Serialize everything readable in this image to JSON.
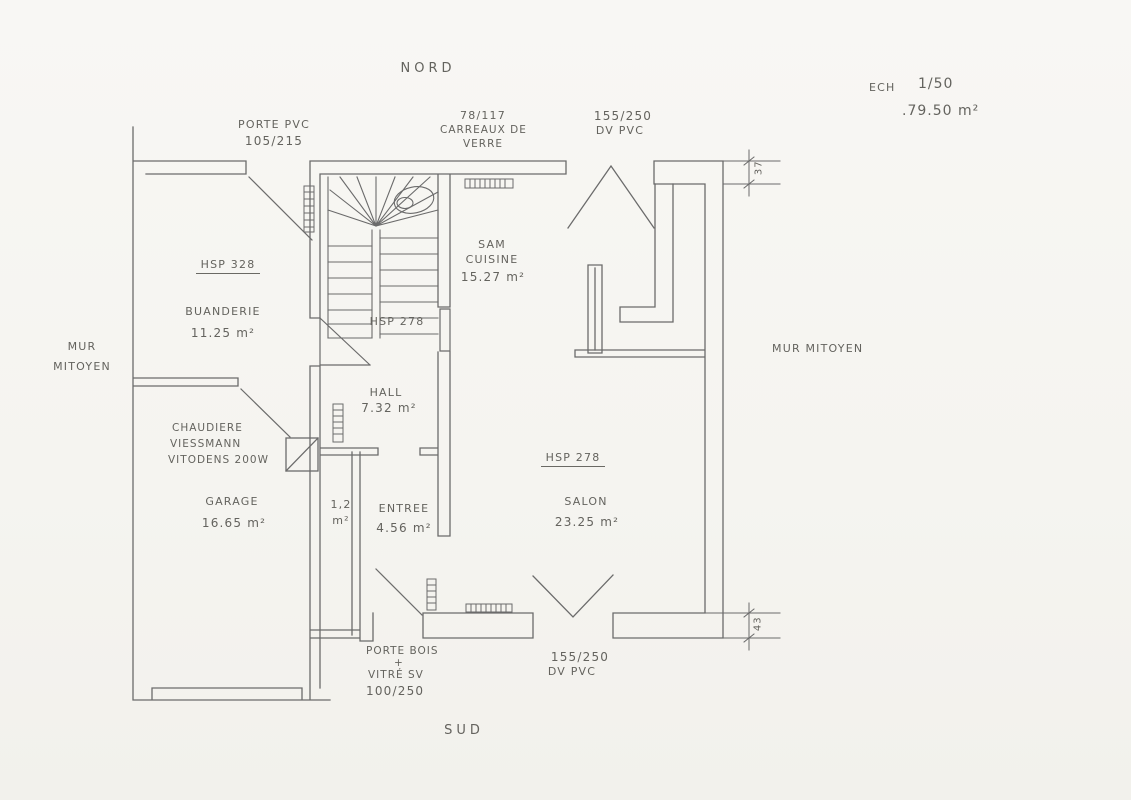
{
  "colors": {
    "paper": "#f6f5f1",
    "ink": "#5f5f5f",
    "text": "#64635e"
  },
  "title_block": {
    "scale_prefix": "ECH",
    "scale_value": "1/50",
    "total_area": ".79.50 m²"
  },
  "compass": {
    "north": "NORD",
    "south": "SUD"
  },
  "party_wall": {
    "left_line1": "MUR",
    "left_line2": "MITOYEN",
    "right": "MUR MITOYEN"
  },
  "openings": {
    "porte_pvc_line1": "PORTE PVC",
    "porte_pvc_line2": "105/215",
    "glass_block_line1": "78/117",
    "glass_block_line2": "CARREAUX DE",
    "glass_block_line3": "VERRE",
    "north_window_line1": "155/250",
    "north_window_line2": "DV PVC",
    "south_window_line1": "155/250",
    "south_window_line2": "DV PVC",
    "porte_bois_line1": "PORTE BOIS",
    "porte_bois_line2": "+",
    "porte_bois_line3": "VITRÉ SV",
    "porte_bois_line4": "100/250"
  },
  "rooms": {
    "buanderie_hsp": "HSP 328",
    "buanderie_name": "BUANDERIE",
    "buanderie_area": "11.25 m²",
    "hall_hsp": "HSP 278",
    "hall_name": "HALL",
    "hall_area": "7.32 m²",
    "sam_line1": "SAM",
    "sam_line2": "CUISINE",
    "sam_area": "15.27 m²",
    "salon_hsp": "HSP 278",
    "salon_name": "SALON",
    "salon_area": "23.25 m²",
    "entree_name": "ENTREE",
    "entree_area": "4.56 m²",
    "wc_area_line1": "1,2",
    "wc_area_line2": "m²",
    "garage_name": "GARAGE",
    "garage_area": "16.65 m²",
    "boiler_line1": "CHAUDIERE",
    "boiler_line2": "VIESSMANN",
    "boiler_line3": "VITODENS 200W"
  },
  "dimensions": {
    "north_wall_offset": "37",
    "south_wall_offset": "43"
  }
}
